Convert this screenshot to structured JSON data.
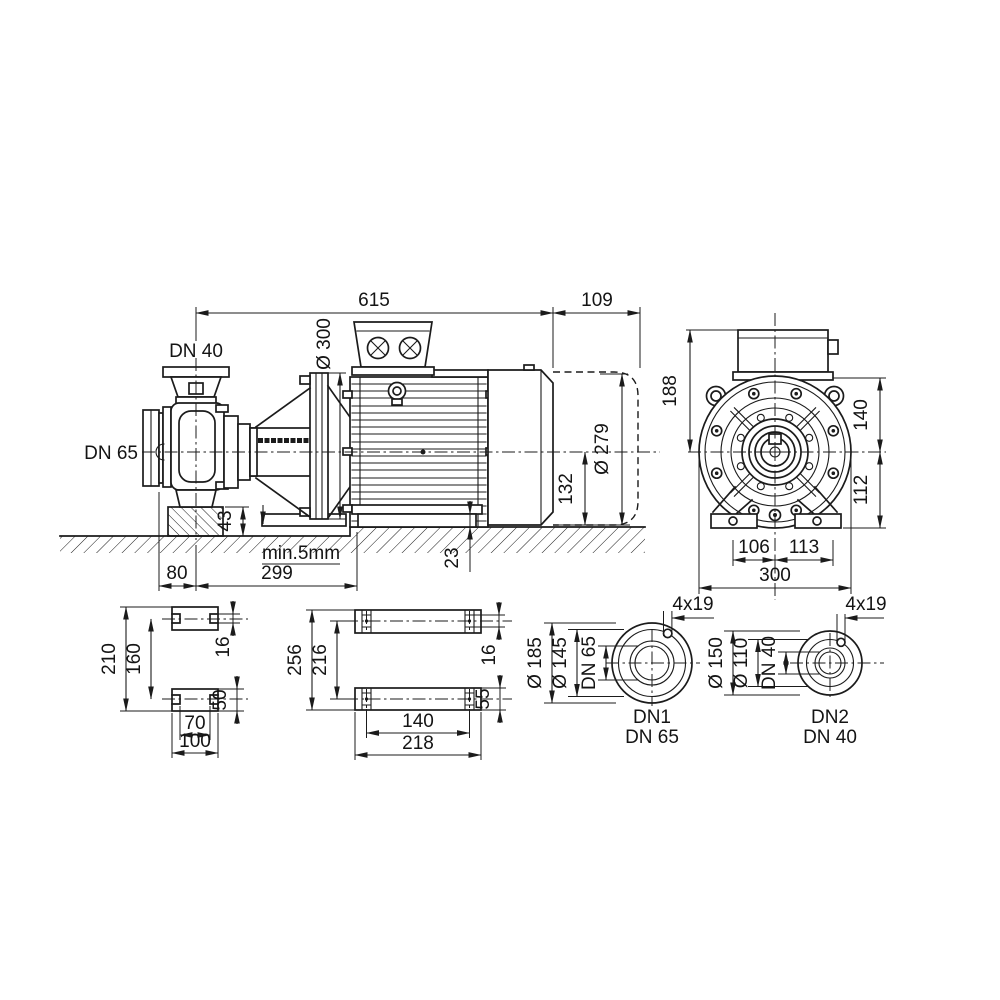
{
  "drawing": {
    "side_view": {
      "overall_length": "615",
      "dismantling_clearance": "109",
      "motor_flange_diameter": "Ø 300",
      "discharge_flange": "DN 40",
      "suction_flange": "DN 65",
      "fan_cover_diameter": "Ø 279",
      "centerline_to_base": "132",
      "pump_support_height": "43",
      "motor_foot_height": "23",
      "minimum_gap": "min.5mm",
      "suction_to_pump_foot": "80",
      "pump_foot_to_motor_foot": "299"
    },
    "end_view": {
      "terminal_box_to_centerline": "188",
      "centerline_to_flange_top": "140",
      "centerline_to_foot": "112",
      "foot_offset_left": "106",
      "foot_offset_right": "113",
      "overall_width": "300"
    },
    "pump_foot_view": {
      "overall_depth": "210",
      "slot_centers": "160",
      "slot_width": "16",
      "foot_depth": "50",
      "slot_inner_span": "70",
      "overall_width": "100"
    },
    "motor_foot_view": {
      "overall_depth": "256",
      "hole_centers_depth": "216",
      "hole_width": "16",
      "foot_depth": "55",
      "hole_centers_width": "140",
      "overall_width": "218"
    },
    "flange_dn1": {
      "outer_diameter": "Ø 185",
      "bolt_circle_diameter": "Ø 145",
      "nominal_bore": "DN 65",
      "bolt_holes": "4x19",
      "caption_line1": "DN1",
      "caption_line2": "DN 65"
    },
    "flange_dn2": {
      "outer_diameter": "Ø 150",
      "bolt_circle_diameter": "Ø 110",
      "nominal_bore": "DN 40",
      "bolt_holes": "4x19",
      "caption_line1": "DN2",
      "caption_line2": "DN 40"
    }
  },
  "colors": {
    "line": "#1b1b1b",
    "background": "#ffffff"
  }
}
